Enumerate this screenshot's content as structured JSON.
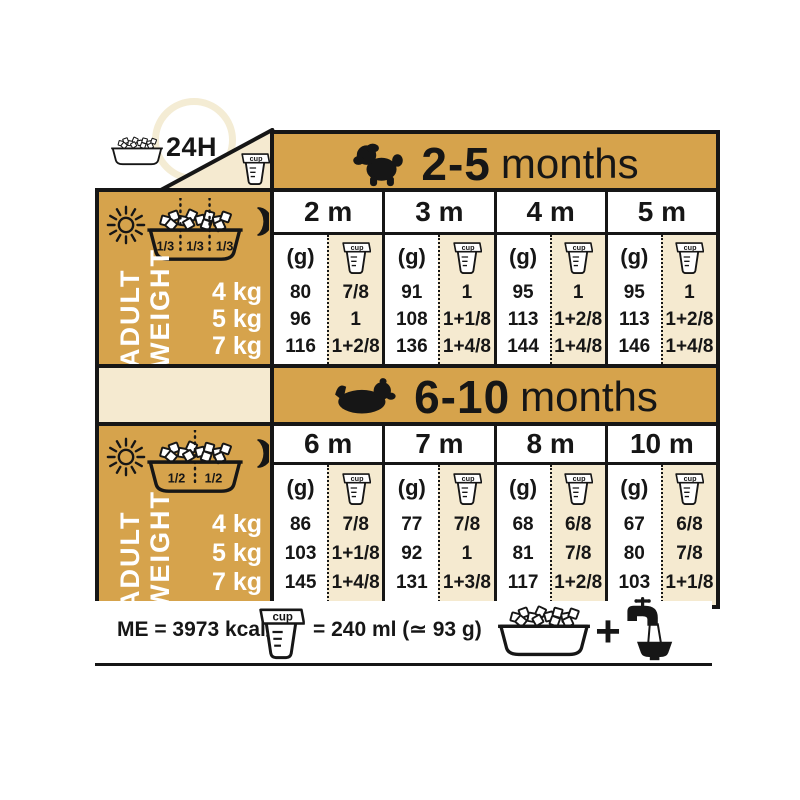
{
  "labels": {
    "hours": "24H",
    "grams_unit": "(g)",
    "cup_word": "cup",
    "adult": "ADULT",
    "weight": "WEIGHT"
  },
  "colors": {
    "gold": "#D6A34C",
    "cream": "#F5EAD0",
    "ink": "#161616"
  },
  "sections": [
    {
      "range": "2-5",
      "suffix": "months",
      "dog_icon": "puppy-silhouette",
      "portions": [
        "1/3",
        "1/3",
        "1/3"
      ],
      "weights": [
        "4 kg",
        "5 kg",
        "7 kg"
      ],
      "months": [
        {
          "label": "2 m",
          "grams": [
            80,
            96,
            116
          ],
          "cups": [
            "7/8",
            "1",
            "1+2/8"
          ]
        },
        {
          "label": "3 m",
          "grams": [
            91,
            108,
            136
          ],
          "cups": [
            "1",
            "1+1/8",
            "1+4/8"
          ]
        },
        {
          "label": "4 m",
          "grams": [
            95,
            113,
            144
          ],
          "cups": [
            "1",
            "1+2/8",
            "1+4/8"
          ]
        },
        {
          "label": "5 m",
          "grams": [
            95,
            113,
            146
          ],
          "cups": [
            "1",
            "1+2/8",
            "1+4/8"
          ]
        }
      ]
    },
    {
      "range": "6-10",
      "suffix": "months",
      "dog_icon": "adult-dog-silhouette",
      "portions": [
        "1/2",
        "1/2"
      ],
      "weights": [
        "4 kg",
        "5 kg",
        "7 kg"
      ],
      "months": [
        {
          "label": "6 m",
          "grams": [
            86,
            103,
            145
          ],
          "cups": [
            "7/8",
            "1+1/8",
            "1+4/8"
          ]
        },
        {
          "label": "7 m",
          "grams": [
            77,
            92,
            131
          ],
          "cups": [
            "7/8",
            "1",
            "1+3/8"
          ]
        },
        {
          "label": "8 m",
          "grams": [
            68,
            81,
            117
          ],
          "cups": [
            "6/8",
            "7/8",
            "1+2/8"
          ]
        },
        {
          "label": "10 m",
          "grams": [
            67,
            80,
            103
          ],
          "cups": [
            "6/8",
            "7/8",
            "1+1/8"
          ]
        }
      ]
    }
  ],
  "footer": {
    "me": "ME = 3973 kcal/kg",
    "equiv": "= 240 ml (≃ 93 g)"
  }
}
